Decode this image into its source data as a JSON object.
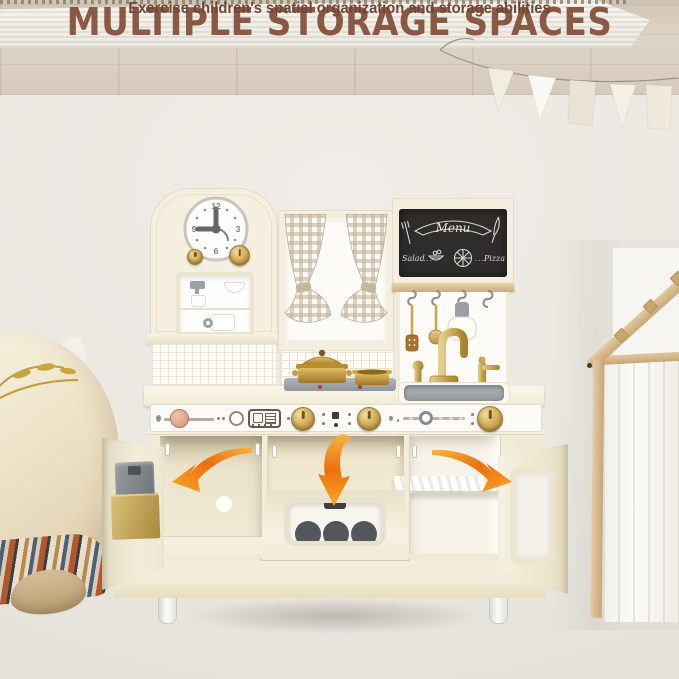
{
  "header": {
    "title": "MULTIPLE STORAGE SPACES",
    "subtitle": "Exercise children's spatial organization and storage abilities"
  },
  "kitchen": {
    "clock": {
      "numbers": [
        "12",
        "3",
        "6",
        "9"
      ]
    },
    "chalkboard": {
      "title": "Menu",
      "left_item": "Salad",
      "left_dots": "....",
      "right_item": "Pizza",
      "right_dots": "...."
    }
  },
  "icons": {
    "arrow_left": "arrow-into-left-cabinet",
    "arrow_down": "arrow-into-oven",
    "arrow_right": "arrow-into-right-cabinet",
    "clock": "analog-clock",
    "hooks": "s-hooks-with-utensils",
    "bunting": "pennant-banner"
  },
  "colors": {
    "title_brown": "#8a5843",
    "subtitle_brown": "#6f4737",
    "kitchen_cream": "#f3eedd",
    "gold_accent": "#cfa952",
    "arrow_orange": "#ec6f0e",
    "chalkboard_dark": "#2e2d2b",
    "metal_gray": "#9aa0a6",
    "wall": "#ece9e4",
    "wood_floor": "#ddd3c5",
    "rug_white": "#f4f3ef",
    "curtain_check": "#c5b49d"
  }
}
